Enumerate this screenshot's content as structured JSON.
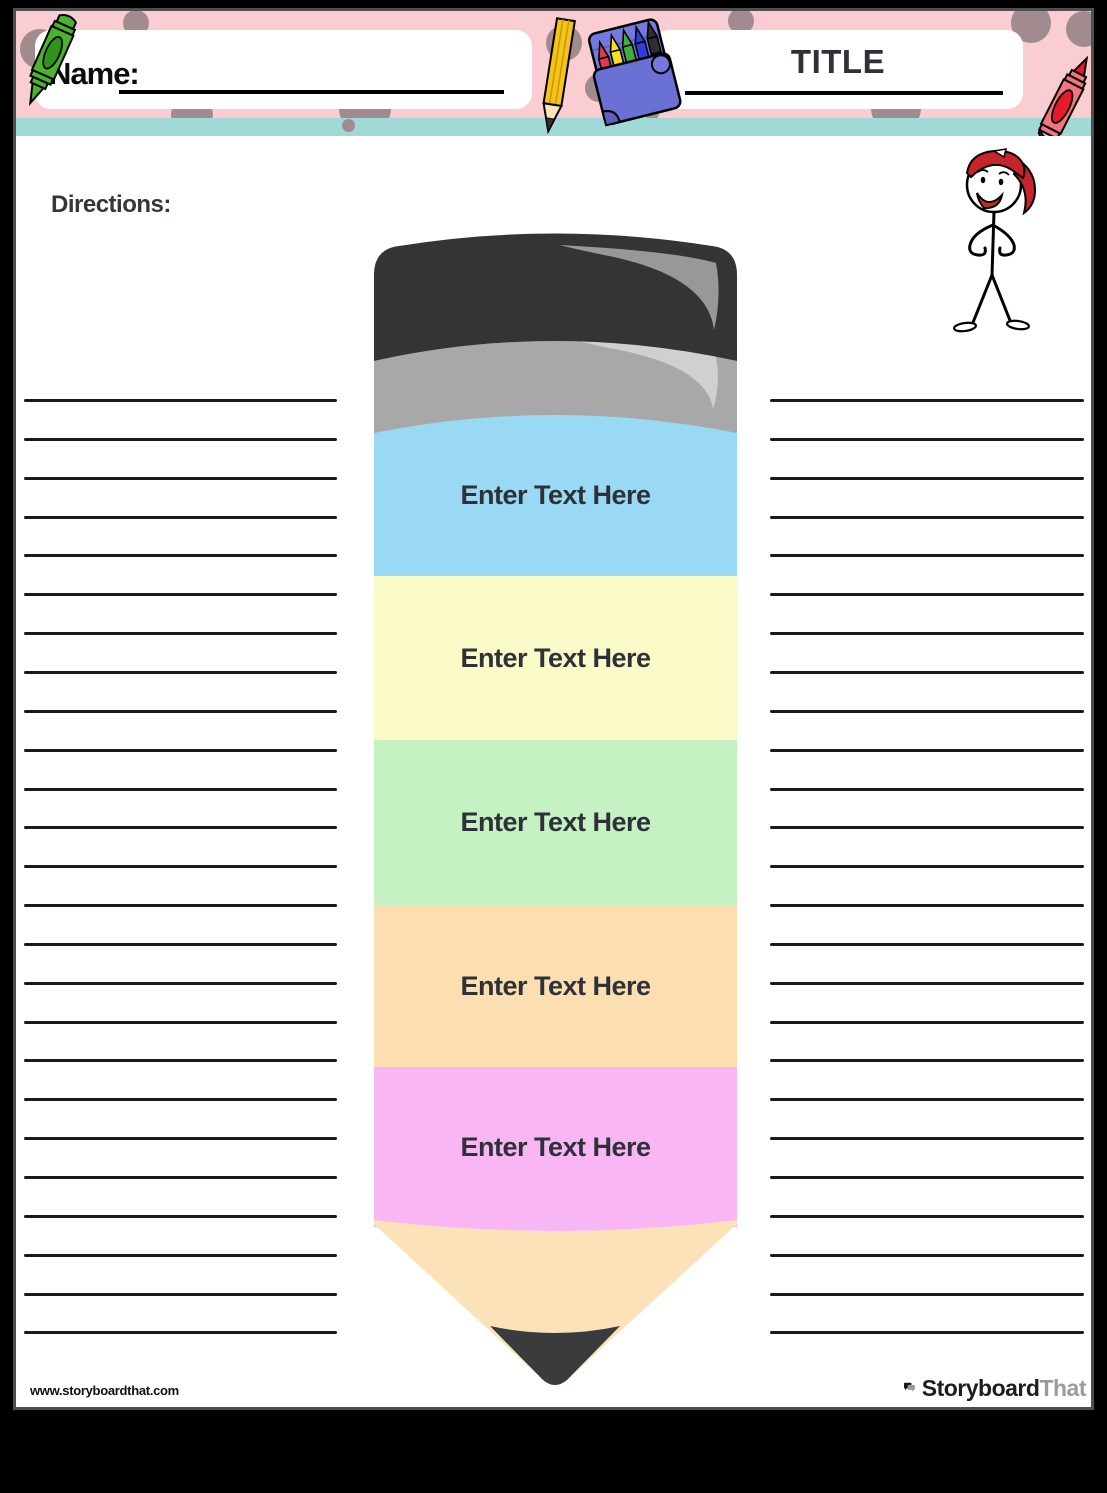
{
  "header": {
    "name_label": "Name:",
    "title": "TITLE",
    "band_color": "#f9cdd2",
    "stripe_color": "#a0d9d6",
    "dot_color": "#a18b8f",
    "decorations": [
      "green-crayon-icon",
      "yellow-pencil-icon",
      "crayon-box-icon",
      "red-crayon-icon"
    ]
  },
  "directions": {
    "label": "Directions:"
  },
  "character": {
    "icon": "stick-figure-red-cap-icon"
  },
  "pencil": {
    "cap_color": "#323435",
    "ferrule_color": "#a8a8a8",
    "wood_color": "#fce2b8",
    "graphite_color": "#3a3b3c",
    "sections": [
      {
        "label": "Enter Text Here",
        "color": "#99d9f3"
      },
      {
        "label": "Enter Text Here",
        "color": "#fafac9"
      },
      {
        "label": "Enter Text Here",
        "color": "#c6f1c2"
      },
      {
        "label": "Enter Text Here",
        "color": "#fcdfb0"
      },
      {
        "label": "Enter Text Here",
        "color": "#f9b6f4"
      }
    ]
  },
  "writing_lines": {
    "per_column": 25,
    "columns": 2,
    "color": "#1a1a1a"
  },
  "footer": {
    "url": "www.storyboardthat.com",
    "logo_icon": "speech-bubbles-icon",
    "logo_primary": "Storyboard",
    "logo_secondary": "That"
  }
}
